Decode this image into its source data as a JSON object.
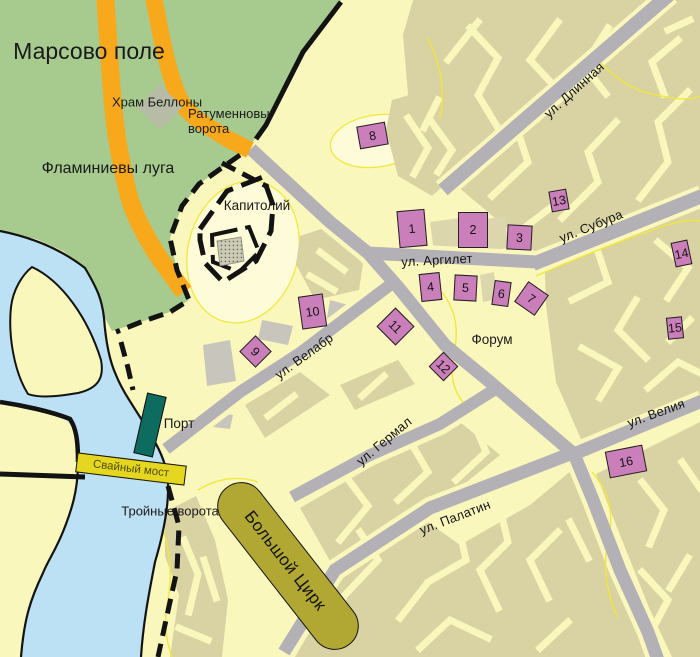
{
  "map": {
    "title": "План древнего Рима (схема города)",
    "labels": {
      "marsovo_pole": "Марсово поле",
      "flaminievy_luga": "Фламиниевы луга",
      "hram_bellony": "Храм Беллоны",
      "ratumennovy_vorota": "Ратуменновы\nворота",
      "kapitoliy": "Капитолий",
      "forum": "Форум",
      "port": "Порт",
      "troynye_vorota": "Тройные ворота"
    },
    "streets": {
      "dlinnaya": "ул. Длинная",
      "subura": "ул. Субура",
      "argilet": "ул. Аргилет",
      "velabr": "ул. Велабр",
      "germal": "ул. Гермал",
      "veliya": "ул. Велия",
      "palatin": "ул. Палатин"
    },
    "features": {
      "circus": "Большой Цирк",
      "bridge": "Свайный мост"
    },
    "markers": [
      {
        "n": "1",
        "x": 412,
        "y": 228,
        "w": 28,
        "h": 37,
        "r": -5
      },
      {
        "n": "2",
        "x": 473,
        "y": 230,
        "w": 30,
        "h": 36,
        "r": 0
      },
      {
        "n": "3",
        "x": 519,
        "y": 237,
        "w": 25,
        "h": 25,
        "r": 3
      },
      {
        "n": "4",
        "x": 430,
        "y": 287,
        "w": 21,
        "h": 28,
        "r": -6
      },
      {
        "n": "5",
        "x": 465,
        "y": 288,
        "w": 23,
        "h": 26,
        "r": 3
      },
      {
        "n": "6",
        "x": 501,
        "y": 293,
        "w": 17,
        "h": 25,
        "r": 8
      },
      {
        "n": "7",
        "x": 531,
        "y": 298,
        "w": 25,
        "h": 25,
        "r": 35
      },
      {
        "n": "8",
        "x": 372,
        "y": 135,
        "w": 29,
        "h": 23,
        "r": -10
      },
      {
        "n": "9",
        "x": 255,
        "y": 351,
        "w": 23,
        "h": 23,
        "r": 45
      },
      {
        "n": "10",
        "x": 312,
        "y": 311,
        "w": 25,
        "h": 33,
        "r": -8
      },
      {
        "n": "11",
        "x": 395,
        "y": 326,
        "w": 27,
        "h": 27,
        "r": 45
      },
      {
        "n": "12",
        "x": 443,
        "y": 366,
        "w": 21,
        "h": 21,
        "r": 45
      },
      {
        "n": "13",
        "x": 559,
        "y": 200,
        "w": 18,
        "h": 21,
        "r": -10
      },
      {
        "n": "14",
        "x": 681,
        "y": 253,
        "w": 17,
        "h": 25,
        "r": -12
      },
      {
        "n": "15",
        "x": 675,
        "y": 328,
        "w": 16,
        "h": 22,
        "r": -6
      },
      {
        "n": "16",
        "x": 626,
        "y": 461,
        "w": 38,
        "h": 27,
        "r": -11
      }
    ],
    "colors": {
      "background": "#FAF7BC",
      "hill_light": "#FEFBD8",
      "contour_line": "#F0E83C",
      "building": "#D9D2A3",
      "building_gray": "#C8C5BD",
      "building_beige": "#DCD6AC",
      "road_gray": "#B3B1B6",
      "road_orange": "#F7A81B",
      "parkland_green": "#A7CB8F",
      "water_blue": "#BCE0F4",
      "wall_black": "#131313",
      "marker": "#CB7FBA",
      "circus": "#B1A733",
      "bridge": "#E5D71F",
      "bridge_text": "#4E4B00",
      "port": "#0E6B5F",
      "label_text": "#1A1A1A"
    }
  }
}
